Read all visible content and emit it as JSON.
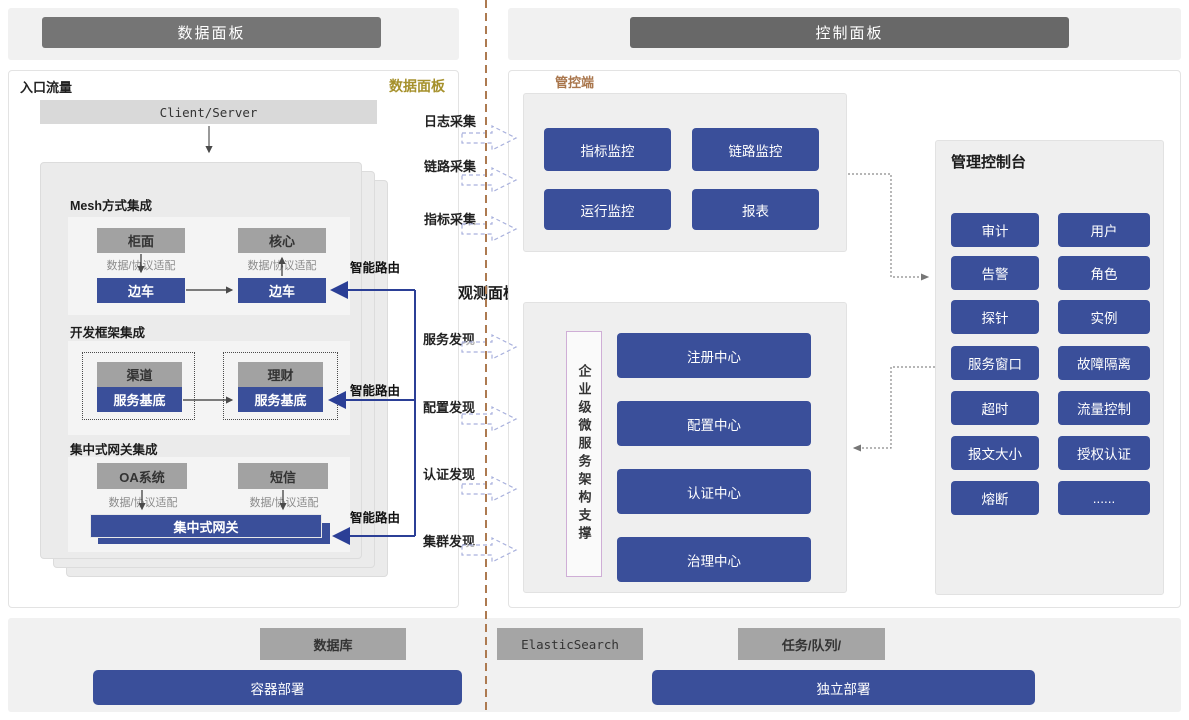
{
  "header": {
    "left_title": "数据面板",
    "right_title": "控制面板"
  },
  "data_panel": {
    "entry_label": "入口流量",
    "corner_label": "数据面板",
    "client_server": "Client/Server",
    "adapter_label": "数据/协议适配",
    "route_label": "智能路由",
    "mesh": {
      "title": "Mesh方式集成",
      "left_top": "柜面",
      "right_top": "核心",
      "left_sidecar": "边车",
      "right_sidecar": "边车"
    },
    "framework": {
      "title": "开发框架集成",
      "left_top": "渠道",
      "right_top": "理财",
      "base_label": "服务基底"
    },
    "gateway": {
      "title": "集中式网关集成",
      "left_top": "OA系统",
      "right_top": "短信",
      "gateway_label": "集中式网关"
    }
  },
  "flow": {
    "collect": [
      "日志采集",
      "链路采集",
      "指标采集"
    ],
    "observe_title": "观测面板",
    "discover": [
      "服务发现",
      "配置发现",
      "认证发现",
      "集群发现"
    ]
  },
  "control_panel": {
    "section_label": "管控端",
    "monitor_buttons": [
      "指标监控",
      "链路监控",
      "运行监控",
      "报表"
    ],
    "observe": {
      "vertical_label": "企业级微服务架构支撑",
      "centers": [
        "注册中心",
        "配置中心",
        "认证中心",
        "治理中心"
      ]
    },
    "console": {
      "title": "管理控制台",
      "buttons": [
        "审计",
        "用户",
        "告警",
        "角色",
        "探针",
        "实例",
        "服务窗口",
        "故障隔离",
        "超时",
        "流量控制",
        "报文大小",
        "授权认证",
        "熔断",
        "......"
      ]
    }
  },
  "infrastructure": {
    "middleware": [
      "数据库",
      "ElasticSearch",
      "任务/队列/"
    ],
    "deployment": [
      "容器部署",
      "独立部署"
    ]
  },
  "colors": {
    "primary_blue": "#3a4f9a",
    "route_blue": "#2b3f96",
    "box_gray": "#a2a2a2",
    "header_gray": "#6e6e6e",
    "accent_gold": "#a6912c",
    "accent_sienna": "#a9764c",
    "divider_brown": "#ad7a50"
  }
}
